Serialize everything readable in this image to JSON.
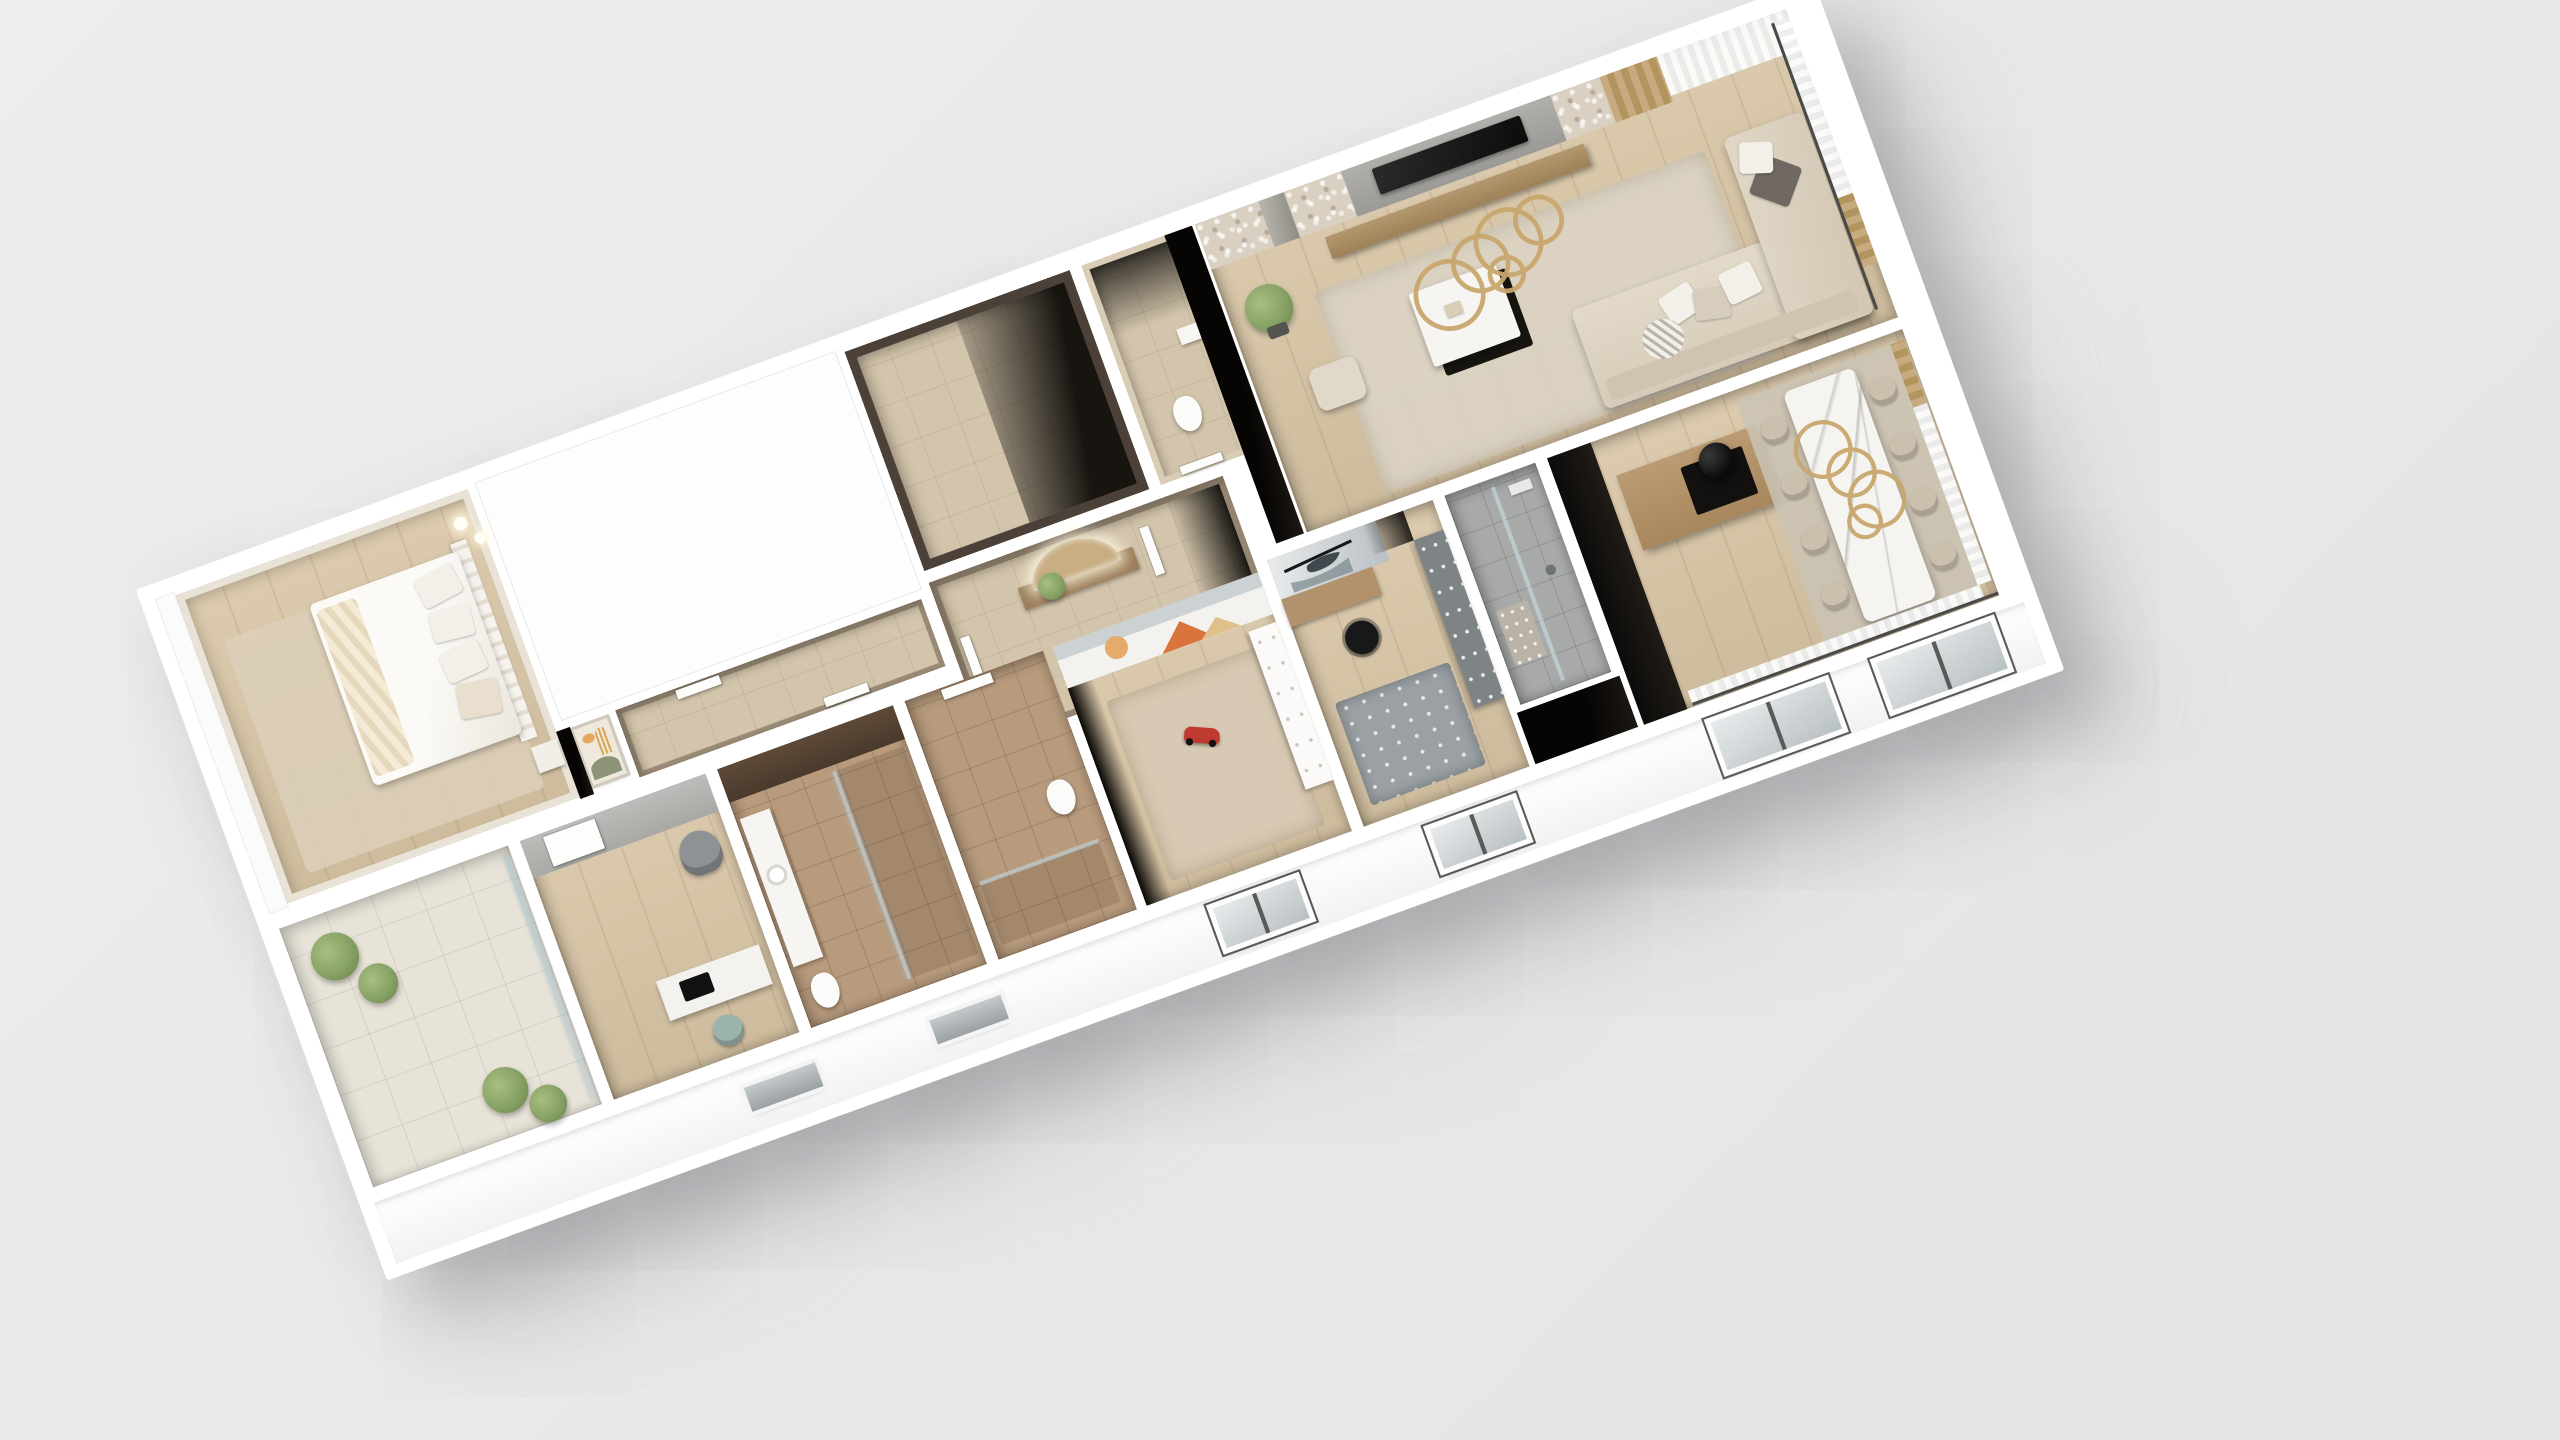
{
  "scene": {
    "type": "3d-floorplan-render",
    "view": "top-down axonometric cutaway, building rotated about 20 degrees",
    "background_color": "#ebebec",
    "no_visible_text": true,
    "rooms": [
      {
        "name": "master-bedroom",
        "floor": "light-oak",
        "items": [
          "double-bed-white-duvet",
          "beige-throw",
          "pillows",
          "area-rug",
          "pendant-lights",
          "nightstand"
        ]
      },
      {
        "name": "terrace-balcony",
        "floor": "beige-ceramic-tile",
        "items": [
          "potted-plant",
          "potted-plant",
          "potted-plant",
          "potted-plant",
          "glass-sliding-door"
        ]
      },
      {
        "name": "study",
        "floor": "light-oak",
        "items": [
          "white-desk",
          "black-monitor",
          "teal-desk-chair",
          "gray-armchair",
          "white-door"
        ]
      },
      {
        "name": "bathroom-main",
        "floor": "brown-marble-tile",
        "items": [
          "walnut-accent-wall",
          "vanity-with-round-sink",
          "toilet",
          "glass-shower-screen"
        ]
      },
      {
        "name": "bathroom-second",
        "floor": "brown-marble-tile",
        "items": [
          "white-door",
          "toilet",
          "glass-shower"
        ]
      },
      {
        "name": "kids-room",
        "floor": "light-oak",
        "items": [
          "beige-area-rug",
          "red-toy-race-car",
          "white-wardrobe",
          "mural-sun-and-mountains"
        ]
      },
      {
        "name": "teen-room",
        "floor": "light-oak",
        "items": [
          "mural-helicopter",
          "wood-corner-desk",
          "black-office-chair",
          "gray-dotted-rug",
          "gray-pegboard-wardrobe"
        ]
      },
      {
        "name": "kids-bathroom",
        "floor": "concrete-tile",
        "items": [
          "walk-in-shower",
          "dotted-bath-mat"
        ]
      },
      {
        "name": "corridor",
        "floor": "beige-tile",
        "items": [
          "arch-artwork",
          "white-doors"
        ]
      },
      {
        "name": "entry-hall",
        "floor": "beige-tile",
        "items": [
          "arched-led-mirror",
          "wood-console",
          "potted-plant",
          "white-doors"
        ]
      },
      {
        "name": "walk-in-closet",
        "floor": "beige-tile",
        "items": []
      },
      {
        "name": "guest-wc",
        "floor": "beige-tile",
        "items": [
          "wall-hung-toilet",
          "small-basin"
        ]
      },
      {
        "name": "living-room",
        "floor": "light-oak",
        "items": [
          "stone-accent-panels",
          "tv-black",
          "wood-media-console",
          "potted-tree",
          "area-rug",
          "white-coffee-table-black-base",
          "pouf",
          "ottoman",
          "sectional-sofa-beige",
          "gold-ring-chandelier",
          "sheer-curtains",
          "beige-drapes"
        ]
      },
      {
        "name": "kitchen-dining",
        "floor": "light-oak",
        "items": [
          "black-kitchen-cabinets",
          "wood-island",
          "black-cylinder-hood",
          "marble-dining-table",
          "dining-chairs-x8",
          "gold-ring-chandelier",
          "area-rug",
          "sheer-curtains",
          "beige-drapes",
          "glass-sliding-doors"
        ]
      }
    ],
    "exterior": {
      "facade_color": "#ffffff",
      "roof_slabs": "plain white over corridor wing and terrace parapet",
      "windows": [
        "slit-window",
        "slit-window",
        "casement-window-pair",
        "casement-window-pair",
        "large-dark-frame-window",
        "large-dark-frame-window"
      ],
      "shadow": "soft gray drop shadow below-left of building"
    }
  },
  "palette": {
    "background": "#ebebec",
    "shell_white": "#ffffff",
    "wood_floor": "#d8c5a5",
    "balcony_tile": "#e7e3d8",
    "beige_tile": "#d3c5ab",
    "brown_tile": "#b89b7d",
    "concrete_tile": "#a7aaa9",
    "dark_wall": "#4c4138",
    "void_black": "#070605",
    "sofa_beige": "#ddd3c3",
    "rug_living": "#dcd4c5",
    "rug_kids": "#d7c9b3",
    "marble_table": "#f6f4f0",
    "island_wood": "#b2926c",
    "gold_accent": "#c9a76d",
    "plant_green": "#87a265",
    "teal_chair": "#9cb3ad",
    "toy_red": "#c0392e",
    "mural_orange": "#d8743c",
    "mural_sun": "#e6aa6a",
    "gray_panel": "#a7a6a2"
  }
}
